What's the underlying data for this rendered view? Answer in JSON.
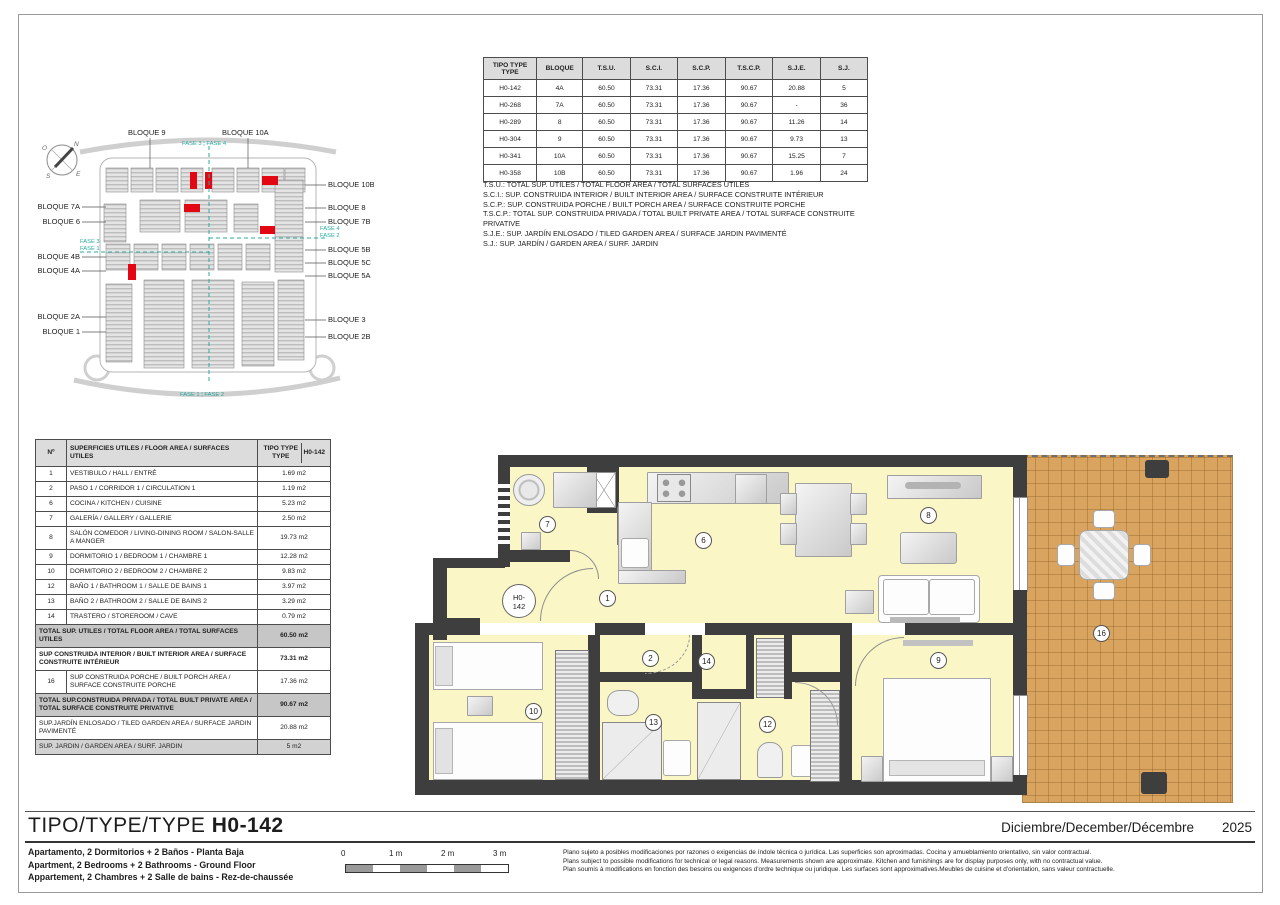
{
  "types_table": {
    "headers": [
      "TIPO TYPE TYPE",
      "BLOQUE",
      "T.S.U.",
      "S.C.I.",
      "S.C.P.",
      "T.S.C.P.",
      "S.J.E.",
      "S.J."
    ],
    "rows": [
      [
        "H0-142",
        "4A",
        "60.50",
        "73.31",
        "17.36",
        "90.67",
        "20.88",
        "5"
      ],
      [
        "H0-268",
        "7A",
        "60.50",
        "73.31",
        "17.36",
        "90.67",
        "-",
        "36"
      ],
      [
        "H0-289",
        "8",
        "60.50",
        "73.31",
        "17.36",
        "90.67",
        "11.26",
        "14"
      ],
      [
        "H0-304",
        "9",
        "60.50",
        "73.31",
        "17.36",
        "90.67",
        "9.73",
        "13"
      ],
      [
        "H0-341",
        "10A",
        "60.50",
        "73.31",
        "17.36",
        "90.67",
        "15.25",
        "7"
      ],
      [
        "H0-358",
        "10B",
        "60.50",
        "73.31",
        "17.36",
        "90.67",
        "1.96",
        "24"
      ]
    ]
  },
  "abbreviations": [
    "T.S.U.: TOTAL SUP. UTILES / TOTAL FLOOR AREA / TOTAL SURFACES UTILES",
    "S.C.I.: SUP. CONSTRUIDA INTERIOR / BUILT INTERIOR AREA / SURFACE CONSTRUITE INTÉRIEUR",
    "S.C.P.: SUP. CONSTRUIDA PORCHE / BUILT PORCH AREA / SURFACE CONSTRUITE PORCHE",
    "T.S.C.P.: TOTAL SUP. CONSTRUIDA PRIVADA / TOTAL BUILT PRIVATE AREA / TOTAL SURFACE CONSTRUITE PRIVATIVE",
    "S.J.E.: SUP. JARDÍN ENLOSADO / TILED GARDEN AREA / SURFACE JARDIN PAVIMENTÉ",
    "S.J.: SUP. JARDÍN / GARDEN AREA / SURF. JARDIN"
  ],
  "site_plan": {
    "top_labels": [
      "BLOQUE 9",
      "BLOQUE 10A"
    ],
    "left_labels": [
      "BLOQUE 7A",
      "BLOQUE 6",
      "BLOQUE 4B",
      "BLOQUE 4A",
      "BLOQUE 2A",
      "BLOQUE 1"
    ],
    "right_labels": [
      "BLOQUE 10B",
      "BLOQUE 8",
      "BLOQUE 7B",
      "BLOQUE 5B",
      "BLOQUE 5C",
      "BLOQUE 5A",
      "BLOQUE 3",
      "BLOQUE 2B"
    ],
    "phase_top": "FASE 3 ¦ FASE 4",
    "phase_left_1": "FASE 3",
    "phase_left_2": "FASE 1",
    "phase_right_1": "FASE 4",
    "phase_right_2": "FASE 2",
    "phase_bottom": "FASE 1 ¦ FASE 2",
    "compass": {
      "n": "N",
      "s": "S",
      "e": "E",
      "o": "O"
    },
    "accent_teal": "#2bab9f",
    "highlight_red": "#e30613"
  },
  "areas_table": {
    "header": {
      "num": "Nº",
      "desc": "SUPERFICIES UTILES / FLOOR AREA / SURFACES UTILES",
      "type": "TIPO TYPE TYPE",
      "code": "H0-142"
    },
    "rows": [
      {
        "n": "1",
        "desc": "VESTIBULO / HALL / ENTRÉ",
        "val": "1.69 m2",
        "cls": ""
      },
      {
        "n": "2",
        "desc": "PASO 1 / CORRIDOR 1 / CIRCULATION 1",
        "val": "1.19 m2",
        "cls": ""
      },
      {
        "n": "6",
        "desc": "COCINA / KITCHEN / CUISINE",
        "val": "5.23 m2",
        "cls": ""
      },
      {
        "n": "7",
        "desc": "GALERÍA / GALLERY / GALLERIE",
        "val": "2.50 m2",
        "cls": ""
      },
      {
        "n": "8",
        "desc": "SALÓN COMEDOR  / LIVING-DINING ROOM / SALON-SALLE A MANGER",
        "val": "19.73 m2",
        "cls": ""
      },
      {
        "n": "9",
        "desc": "DORMITORIO 1 / BEDROOM 1 / CHAMBRE 1",
        "val": "12.28 m2",
        "cls": ""
      },
      {
        "n": "10",
        "desc": "DORMITORIO 2 / BEDROOM 2 / CHAMBRE 2",
        "val": "9.83 m2",
        "cls": ""
      },
      {
        "n": "12",
        "desc": "BAÑO 1 / BATHROOM 1 / SALLE DE BAINS 1",
        "val": "3.97 m2",
        "cls": ""
      },
      {
        "n": "13",
        "desc": "BAÑO 2 / BATHROOM 2 / SALLE DE BAINS 2",
        "val": "3.29 m2",
        "cls": ""
      },
      {
        "n": "14",
        "desc": "TRASTERO / STOREROOM / CAVE",
        "val": "0.79 m2",
        "cls": ""
      },
      {
        "n": "",
        "desc": "TOTAL SUP. UTILES / TOTAL FLOOR AREA / TOTAL SURFACES UTILES",
        "val": "60.50 m2",
        "cls": "total"
      },
      {
        "n": "",
        "desc": "SUP CONSTRUIDA INTERIOR / BUILT INTERIOR AREA / SURFACE CONSTRUITE INTÉRIEUR",
        "val": "73.31 m2",
        "cls": "bold"
      },
      {
        "n": "16",
        "desc": "SUP CONSTRUIDA PORCHE  / BUILT PORCH AREA / SURFACE CONSTRUITE PORCHE",
        "val": "17.36 m2",
        "cls": ""
      },
      {
        "n": "",
        "desc": "TOTAL SUP.CONSTRUIDA PRIVADA / TOTAL  BUILT PRIVATE AREA / TOTAL SURFACE CONSTRUITE PRIVATIVE",
        "val": "90.67 m2",
        "cls": "total"
      },
      {
        "n": "",
        "desc": "SUP.JARDÍN ENLOSADO / TILED GARDEN AREA / SURFACE JARDIN PAVIMENTÉ",
        "val": "20.88 m2",
        "cls": ""
      },
      {
        "n": "",
        "desc": "SUP. JARDIN / GARDEN AREA / SURF. JARDIN",
        "val": "5 m2",
        "cls": "shade"
      }
    ]
  },
  "floor_plan": {
    "unit_line1": "H0-",
    "unit_line2": "142",
    "rooms": {
      "r1": "1",
      "r2": "2",
      "r6": "6",
      "r7": "7",
      "r8": "8",
      "r9": "9",
      "r10": "10",
      "r12": "12",
      "r13": "13",
      "r14": "14",
      "r16": "16"
    },
    "wall_color": "#3e3e3e",
    "room_color": "#faf6c5",
    "terrace_color": "#d9a45f"
  },
  "footer": {
    "title_prefix": "TIPO/TYPE/TYPE",
    "title_code": "H0-142",
    "date_words": "Diciembre/December/Décembre",
    "year": "2025",
    "subtitles": [
      "Apartamento, 2 Dormitorios + 2 Baños - Planta Baja",
      "Apartment, 2 Bedrooms + 2 Bathrooms - Ground Floor",
      "Appartement, 2 Chambres + 2 Salle de bains - Rez-de-chaussée"
    ],
    "scale_labels": [
      "0",
      "1 m",
      "2 m",
      "3 m"
    ],
    "disclaimer": [
      "Plano sujeto a posibles modificaciones por razones o exigencias de índole técnica o jurídica. Las superficies son aproximadas. Cocina y amueblamiento orientativo, sin valor contractual.",
      "Plans subject to possible modifications for technical or legal reasons. Measurements shown are approximate. Kitchen and furnishings are for display purposes only, with no contractual value.",
      "Plan soumis à modifications en fonction des besoins ou exigences d'ordre technique ou juridique. Les surfaces sont approximatives.Meubles de cuisine et d'orientation, sans valeur contractuelle."
    ]
  }
}
